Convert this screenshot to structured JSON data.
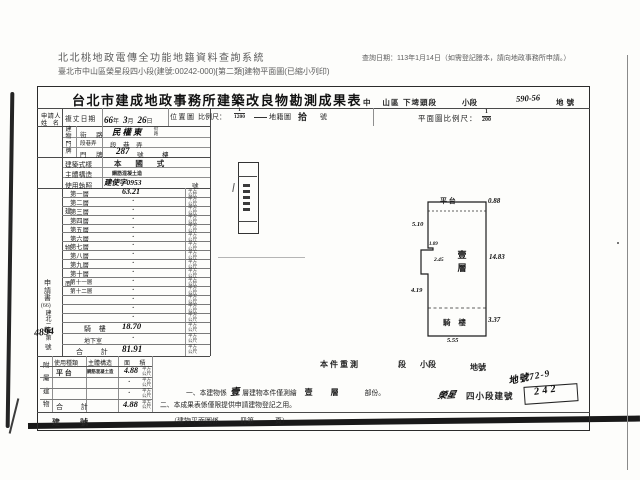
{
  "header": {
    "system_title": "北北桃地政電傳全功能地籍資料查詢系統",
    "query_date": "查詢日期：113年1月14日（如需登記謄本，請向地政事務所申請。）",
    "document_line": "臺北市中山區榮星段四小段(建號:00242-000)[第二類]建物平面圖(已縮小列印)"
  },
  "form": {
    "title": "台北市建成地政事務所建築改良物勘測成果表",
    "district": {
      "city_district": "中 山",
      "district_suffix": "區",
      "section": "下埤頭段",
      "subsection_label": "小段",
      "land_no_hw": "590-56",
      "land_no_label": "地號"
    },
    "location_header": {
      "label": "位置圖",
      "scale_label": "比例尺：",
      "scale_num": "1",
      "scale_den": "1200",
      "cadastral_label": "地籍圖",
      "sheet_hw": "拾",
      "sheet_suffix": "號"
    },
    "plan_header": {
      "label": "平面圖比例尺：",
      "scale_num": "1",
      "scale_den": "200"
    },
    "applicant": {
      "line1": "申請人",
      "line2": "姓 名"
    },
    "survey_date": {
      "label": "複丈日期",
      "year": "66",
      "year_u": "年",
      "month": "3",
      "month_u": "月",
      "day": "26",
      "day_u": "日"
    },
    "address": {
      "group_label": "建物門牌",
      "street_label": "街 路",
      "street_value": "民權東",
      "street_suffix": "街路",
      "lane_label": "段巷弄",
      "lane_value": "段　巷　弄",
      "door_label": "門 牌",
      "door_value": "287",
      "door_no": "號",
      "door_floor": "樓"
    },
    "style": {
      "label": "建築式樣",
      "value": "本 國 式"
    },
    "structure": {
      "label": "主體構造",
      "value": "鋼筋混凝土造"
    },
    "license": {
      "label": "使用執照",
      "value": "建使字0953",
      "suffix": "號"
    },
    "area_chars": [
      "建",
      "物",
      "面",
      "積"
    ],
    "main_table": {
      "unit": "平方公尺",
      "floors": [
        {
          "label": "第一層",
          "value": "63.21"
        },
        {
          "label": "第二層",
          "value": "·"
        },
        {
          "label": "第三層",
          "value": "·"
        },
        {
          "label": "第四層",
          "value": "·"
        },
        {
          "label": "第五層",
          "value": "·"
        },
        {
          "label": "第六層",
          "value": "·"
        },
        {
          "label": "第七層",
          "value": "·"
        },
        {
          "label": "第八層",
          "value": "·"
        },
        {
          "label": "第九層",
          "value": "·"
        },
        {
          "label": "第十層",
          "value": "·"
        },
        {
          "label": "第十一層",
          "value": "·"
        },
        {
          "label": "第十二層",
          "value": "·"
        },
        {
          "label": "",
          "value": "·"
        },
        {
          "label": "",
          "value": "·"
        },
        {
          "label": "",
          "value": "·"
        },
        {
          "label": "騎 樓",
          "value": "18.70"
        },
        {
          "label": "地下室",
          "value": "·"
        }
      ],
      "total_label": "合 計",
      "total_value": "81.91"
    },
    "doc_no": {
      "p1": "申請書",
      "p2": "(66)",
      "p3": "建北二字第",
      "p4": "4894",
      "p5": "號"
    },
    "attached": {
      "group_chars": [
        "附",
        "屬",
        "建",
        "物"
      ],
      "headers": {
        "use": "使用種類",
        "structure": "主體構造",
        "area": "面 積"
      },
      "row": {
        "use": "平 台",
        "structure": "鋼筋混凝土造",
        "area": "4.88"
      },
      "blank_value": "·",
      "total_label": "合 計",
      "total_value": "4.88"
    },
    "resurvey": {
      "p1": "本件重測",
      "p2": "段",
      "p3": "小段",
      "p4": "地號"
    },
    "notes": {
      "n1_a": "一、本建物係",
      "n1_fill": "壹",
      "n1_b": "層建物本件僅測繪",
      "n1_c": "壹 層",
      "n1_d": "部份。",
      "n2": "二、本成果表係僅限提供申請建物登記之用。"
    },
    "bottom": {
      "building_no_label": "建 號",
      "page_note": "（建物平面圖係　　　冊第　　　頁）"
    },
    "handwritten": {
      "land_no": "地號72-9",
      "section": "榮星",
      "stamp": "四小段建號",
      "building_no": "242"
    },
    "diagram": {
      "labels": {
        "platform": "平 台",
        "floor": "壹層",
        "arcade": "騎 樓"
      },
      "dims": {
        "top": "0.88",
        "left_upper": "5.10",
        "notch_a": "1.09",
        "notch_b": "2.45",
        "left_lower": "4.19",
        "right": "14.83",
        "arcade": "3.37",
        "bottom": "5.55"
      }
    }
  }
}
